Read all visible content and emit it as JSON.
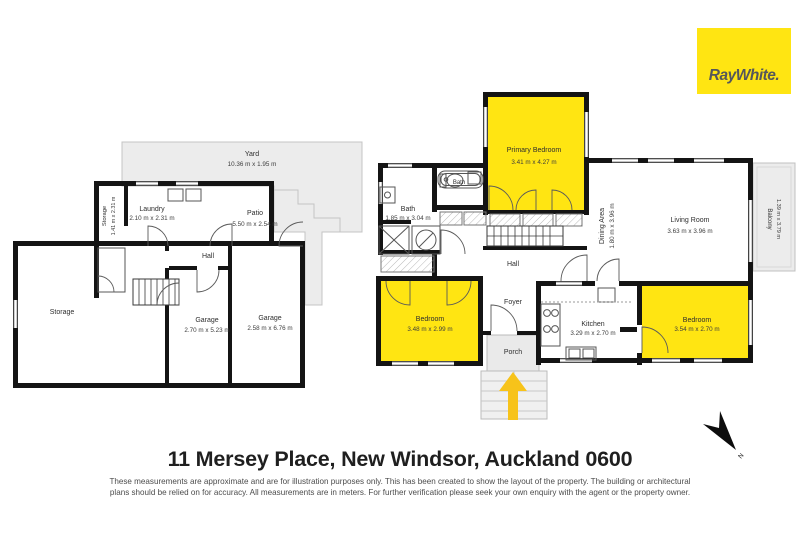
{
  "logo": {
    "text": "RayWhite."
  },
  "address": "11 Mersey Place, New Windsor, Auckland 0600",
  "disclaimer": {
    "line1": "These measurements are approximate and are for illustration purposes only. This has been created to show the layout of the property. The building or architectural",
    "line2": "plans should be relied on for accuracy. All measurements are in meters. For further verification please seek your own enquiry with the agent or the property owner."
  },
  "compass": {
    "label": "N"
  },
  "colors": {
    "highlight_yellow": "#FFE512",
    "wall_black": "#141414",
    "outdoor_gray": "#ECECEC",
    "entry_arrow_gold": "#F7C31A",
    "logo_bg": "#FFE512",
    "logo_text": "#54575B"
  },
  "floor1": {
    "yard": {
      "name": "Yard",
      "dims": "10.36 m x 1.95 m"
    },
    "patio": {
      "name": "Patio",
      "dims": "5.50 m x 2.54 m"
    },
    "storage_small": {
      "name": "Storage",
      "dims": "1.41 m x 2.31 m"
    },
    "laundry": {
      "name": "Laundry",
      "dims": "2.10 m x 2.31 m"
    },
    "hall": {
      "name": "Hall"
    },
    "storage": {
      "name": "Storage"
    },
    "garage1": {
      "name": "Garage",
      "dims": "2.70 m x 5.23 m"
    },
    "garage2": {
      "name": "Garage",
      "dims": "2.58 m x 6.76 m"
    }
  },
  "floor2": {
    "primary_bedroom": {
      "name": "Primary Bedroom",
      "dims": "3.41 m x 4.27 m"
    },
    "bath_small": {
      "name": "Bath"
    },
    "bath": {
      "name": "Bath",
      "dims": "1.85 m x 3.04 m"
    },
    "dining": {
      "name": "Dining Area",
      "dims": "1.80 m x 3.96 m"
    },
    "living": {
      "name": "Living Room",
      "dims": "3.63 m x 3.96 m"
    },
    "balcony": {
      "name": "Balcony",
      "dims": "1.39 m x 3.79 m"
    },
    "hall": {
      "name": "Hall"
    },
    "foyer": {
      "name": "Foyer"
    },
    "porch": {
      "name": "Porch"
    },
    "bedroom1": {
      "name": "Bedroom",
      "dims": "3.48 m x 2.99 m"
    },
    "kitchen": {
      "name": "Kitchen",
      "dims": "3.29 m x 2.70 m"
    },
    "bedroom2": {
      "name": "Bedroom",
      "dims": "3.54 m x 2.70 m"
    }
  }
}
